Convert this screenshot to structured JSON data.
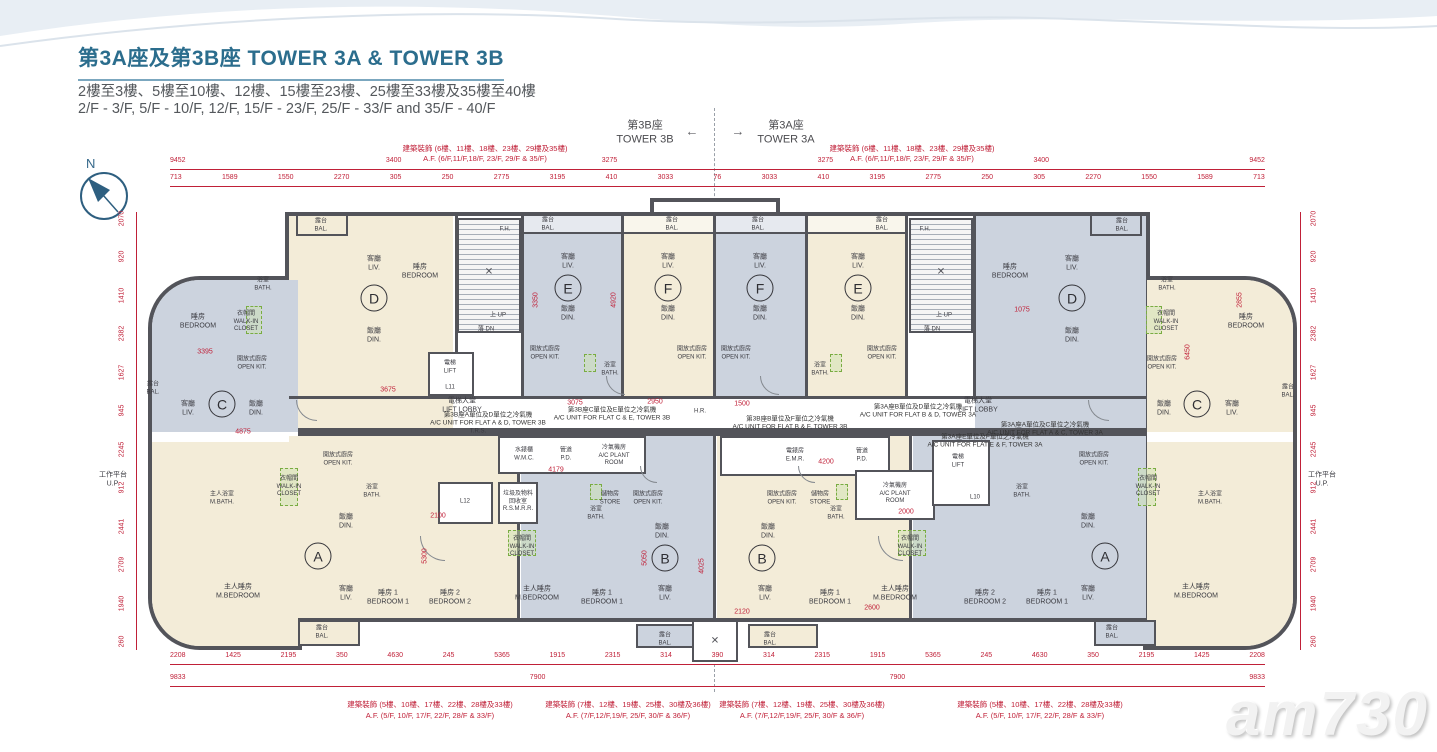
{
  "page": {
    "title": "第3A座及第3B座  TOWER 3A & TOWER 3B",
    "subtitle_zh": "2樓至3樓、5樓至10樓、12樓、15樓至23樓、25樓至33樓及35樓至40樓",
    "subtitle_en": "2/F - 3/F, 5/F - 10/F, 12/F, 15/F - 23/F, 25/F - 33/F and 35/F - 40/F",
    "north": "N",
    "watermark": "am730"
  },
  "towers": {
    "left": "第3B座\nTOWER 3B",
    "right": "第3A座\nTOWER 3A",
    "arrow_left": "←",
    "arrow_right": "→"
  },
  "notes": {
    "af_floors_6": "建築裝飾 (6樓、11樓、18樓、23樓、29樓及35樓)\nA.F. (6/F,11/F,18/F, 23/F, 29/F & 35/F)",
    "af_floors_5": "建築裝飾 (5樓、10樓、17樓、22樓、28樓及33樓)\nA.F. (5/F, 10/F, 17/F, 22/F, 28/F & 33/F)",
    "af_floors_7": "建築裝飾 (7樓、12樓、19樓、25樓、30樓及36樓)\nA.F. (7/F,12/F,19/F, 25/F, 30/F & 36/F)"
  },
  "ac_notes": {
    "ad3b": "第3B座A單位及D單位之冷氣機\nA/C UNIT FOR FLAT A & D, TOWER 3B",
    "ce3b": "第3B座C單位及E單位之冷氣機\nA/C UNIT FOR FLAT C & E, TOWER 3B",
    "bf3b": "第3B座B單位及F單位之冷氣機\nA/C UNIT FOR FLAT B & F, TOWER 3B",
    "bd3a": "第3A座B單位及D單位之冷氣機\nA/C UNIT FOR FLAT B & D, TOWER 3A",
    "ef3a": "第3A座E單位及F單位之冷氣機\nA/C UNIT FOR FLAT E & F, TOWER 3A",
    "ac3a": "第3A座A單位及C單位之冷氣機\nA/C UNIT FOR FLAT A & C, TOWER 3A"
  },
  "units": {
    "a": "A",
    "b": "B",
    "c": "C",
    "d": "D",
    "e": "E",
    "f": "F"
  },
  "labels": {
    "liv": "客廳\nLIV.",
    "din": "飯廳\nDIN.",
    "bedroom": "睡房\nBEDROOM",
    "bedroom1": "睡房 1\nBEDROOM 1",
    "bedroom2": "睡房 2\nBEDROOM 2",
    "mbedroom": "主人睡房\nM.BEDROOM",
    "bath": "浴室\nBATH.",
    "mbath": "主人浴室\nM.BATH.",
    "bal": "露台\nBAL.",
    "openkit": "開放式廚房\nOPEN KIT.",
    "walkin": "衣帽間\nWALK-IN\nCLOSET",
    "store": "儲物房\nSTORE",
    "up": "工作平台\nU.P.",
    "lift": "電梯\nLIFT",
    "liftlobby": "電梯大堂\nLIFT LOBBY",
    "emr": "電錶房\nE.M.R.",
    "pd": "管道\nP.D.",
    "wmc": "水錶櫃\nW.M.C.",
    "acplant": "冷氣機房\nA/C PLANT\nROOM",
    "rsmrr": "垃圾及物料\n回收室\nR.S.M.R.R.",
    "trs": "T.R.S.",
    "hr": "H.R.",
    "fh": "F.H.",
    "stairup": "上 UP",
    "stairdn": "落 DN",
    "l10": "L10",
    "l11": "L11",
    "l12": "L12",
    "cross": "✕"
  },
  "dims": {
    "top_row1": [
      "9452",
      "3400",
      "3275",
      "3275",
      "3400",
      "9452"
    ],
    "top_row2": [
      "713",
      "1589",
      "1550",
      "2270",
      "305",
      "250",
      "2775",
      "3195",
      "410",
      "3033",
      "76",
      "3033",
      "410",
      "3195",
      "2775",
      "250",
      "305",
      "2270",
      "1550",
      "1589",
      "713"
    ],
    "bottom_row1": [
      "2208",
      "1425",
      "2195",
      "350",
      "4630",
      "245",
      "5365",
      "1915",
      "2315",
      "314",
      "390",
      "314",
      "2315",
      "1915",
      "5365",
      "245",
      "4630",
      "350",
      "2195",
      "1425",
      "2208"
    ],
    "bottom_row2": [
      "9833",
      "7900",
      "7900",
      "9833"
    ],
    "side_left": [
      "2070",
      "920",
      "1410",
      "2382",
      "1627",
      "945",
      "2245",
      "912",
      "2441",
      "2709",
      "1940",
      "260"
    ],
    "side_right": [
      "2070",
      "920",
      "1410",
      "2382",
      "1627",
      "945",
      "2245",
      "912",
      "2441",
      "2709",
      "1940",
      "260"
    ],
    "inner": [
      "3675",
      "3075",
      "2950",
      "1500",
      "4179",
      "4200",
      "2000",
      "2100",
      "3350",
      "4920",
      "5050",
      "4025",
      "2600",
      "2120",
      "4875",
      "3395",
      "1075",
      "6450",
      "5300",
      "2855"
    ]
  }
}
